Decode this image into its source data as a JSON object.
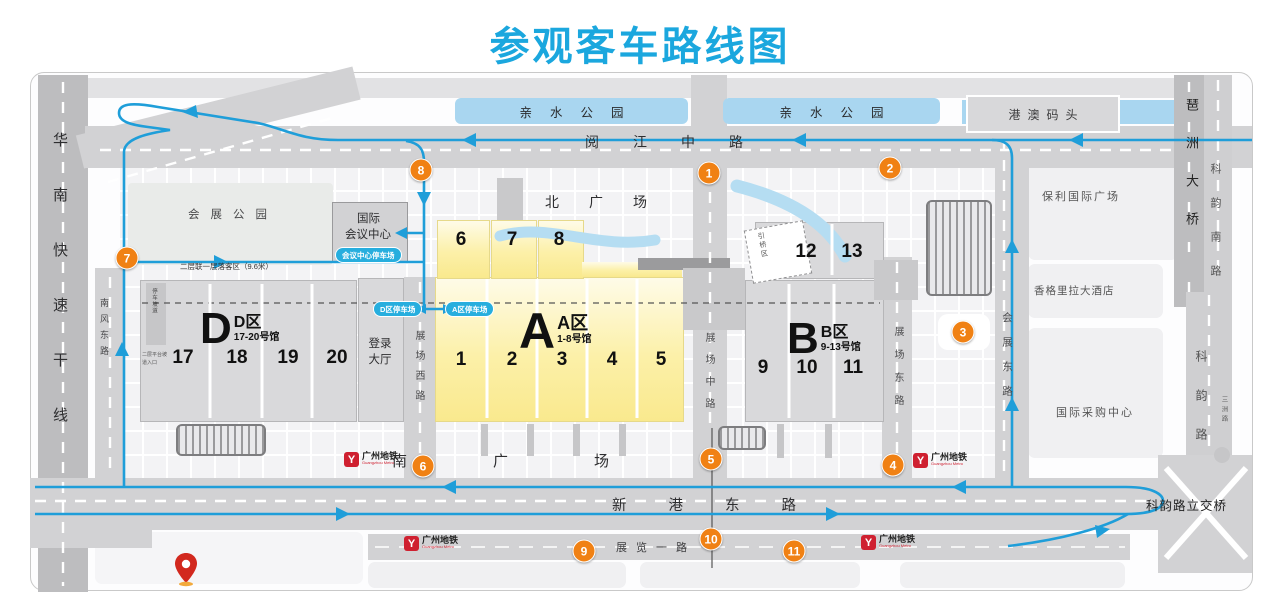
{
  "title": "参观客车路线图",
  "colors": {
    "title": "#1ba7de",
    "route": "#1f9ed9",
    "marker": "#f08114",
    "metro_red": "#cf2030",
    "water": "#a9d6f0",
    "zone_yellow": "#fbe98e"
  },
  "roads": {
    "huanan_expressway": "华南快速干线",
    "yuejiang_middle": "阅江中路",
    "xingang_east": "新港东路",
    "zhanlan_yi": "展览一路",
    "huizhan_east": "会展东路",
    "zhanchang_middle": "展场中路",
    "zhanchang_west": "展场西路",
    "zhanchang_east": "展场东路",
    "nanfeng_east": "南风东路",
    "pazhou_bridge": "琶洲大桥",
    "keyun_south": "科韵南路",
    "keyun": "科韵路",
    "keyun_interchange": "科韵路立交桥",
    "sanzhou": "三洲路"
  },
  "places": {
    "qinshui_park": "亲水公园",
    "gangao_pier": "港澳码头",
    "huizhan_park": "会展公园",
    "conference_center": [
      "国际",
      "会议中心"
    ],
    "login_hall": "登录大厅",
    "north_plaza": "北广场",
    "south_plaza": "南广场",
    "poly_plaza": "保利国际广场",
    "shangrila_hotel": "香格里拉大酒店",
    "sourcing_center": "国际采购中心",
    "ramp_area": "引桥区"
  },
  "zones": {
    "a": {
      "letter": "A",
      "name": "A区",
      "range": "1-8号馆",
      "lower": [
        "1",
        "2",
        "3",
        "4",
        "5"
      ],
      "upper": [
        "6",
        "7",
        "8"
      ]
    },
    "b": {
      "letter": "B",
      "name": "B区",
      "range": "9-13号馆",
      "lower": [
        "9",
        "10",
        "11"
      ],
      "upper": [
        "12",
        "13"
      ]
    },
    "d": {
      "letter": "D",
      "name": "D区",
      "range": "17-20号馆",
      "lower": [
        "17",
        "18",
        "19",
        "20"
      ]
    }
  },
  "parking": {
    "conference_lot": "会议中心停车场",
    "d_lot": "D区停车场",
    "a_lot": "A区停车场",
    "deck_note": "二层联一层落客区（9.6米）",
    "ramp_bar": "停车坡道",
    "ramp_small": "二层平台坡道入口"
  },
  "metro": {
    "name": "广州地铁",
    "en": "Guangzhou Metro"
  },
  "markers": [
    "1",
    "2",
    "3",
    "4",
    "5",
    "6",
    "7",
    "8",
    "9",
    "10",
    "11"
  ]
}
